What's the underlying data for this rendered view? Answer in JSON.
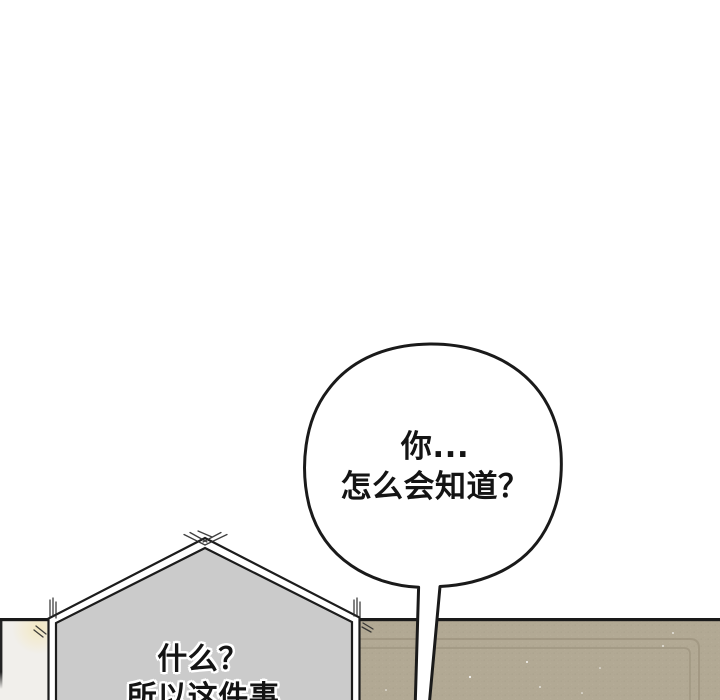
{
  "panel": {
    "speech_bubble_round": {
      "line1": "你...",
      "line2": "怎么会知道？"
    },
    "speech_bubble_pentagon": {
      "line1": "什么？",
      "line2": "所以这件事"
    }
  },
  "colors": {
    "background": "#ffffff",
    "ink": "#1a1a1a",
    "text_ink": "#141414",
    "bubble_fill": "#ffffff",
    "pentagon_fill": "#cbcbcb",
    "wall_tan": "#b2a994",
    "wall_molding": "#9d947f",
    "left_wall": "#f1efeb",
    "left_wall_glow": "#f3e8c0"
  }
}
